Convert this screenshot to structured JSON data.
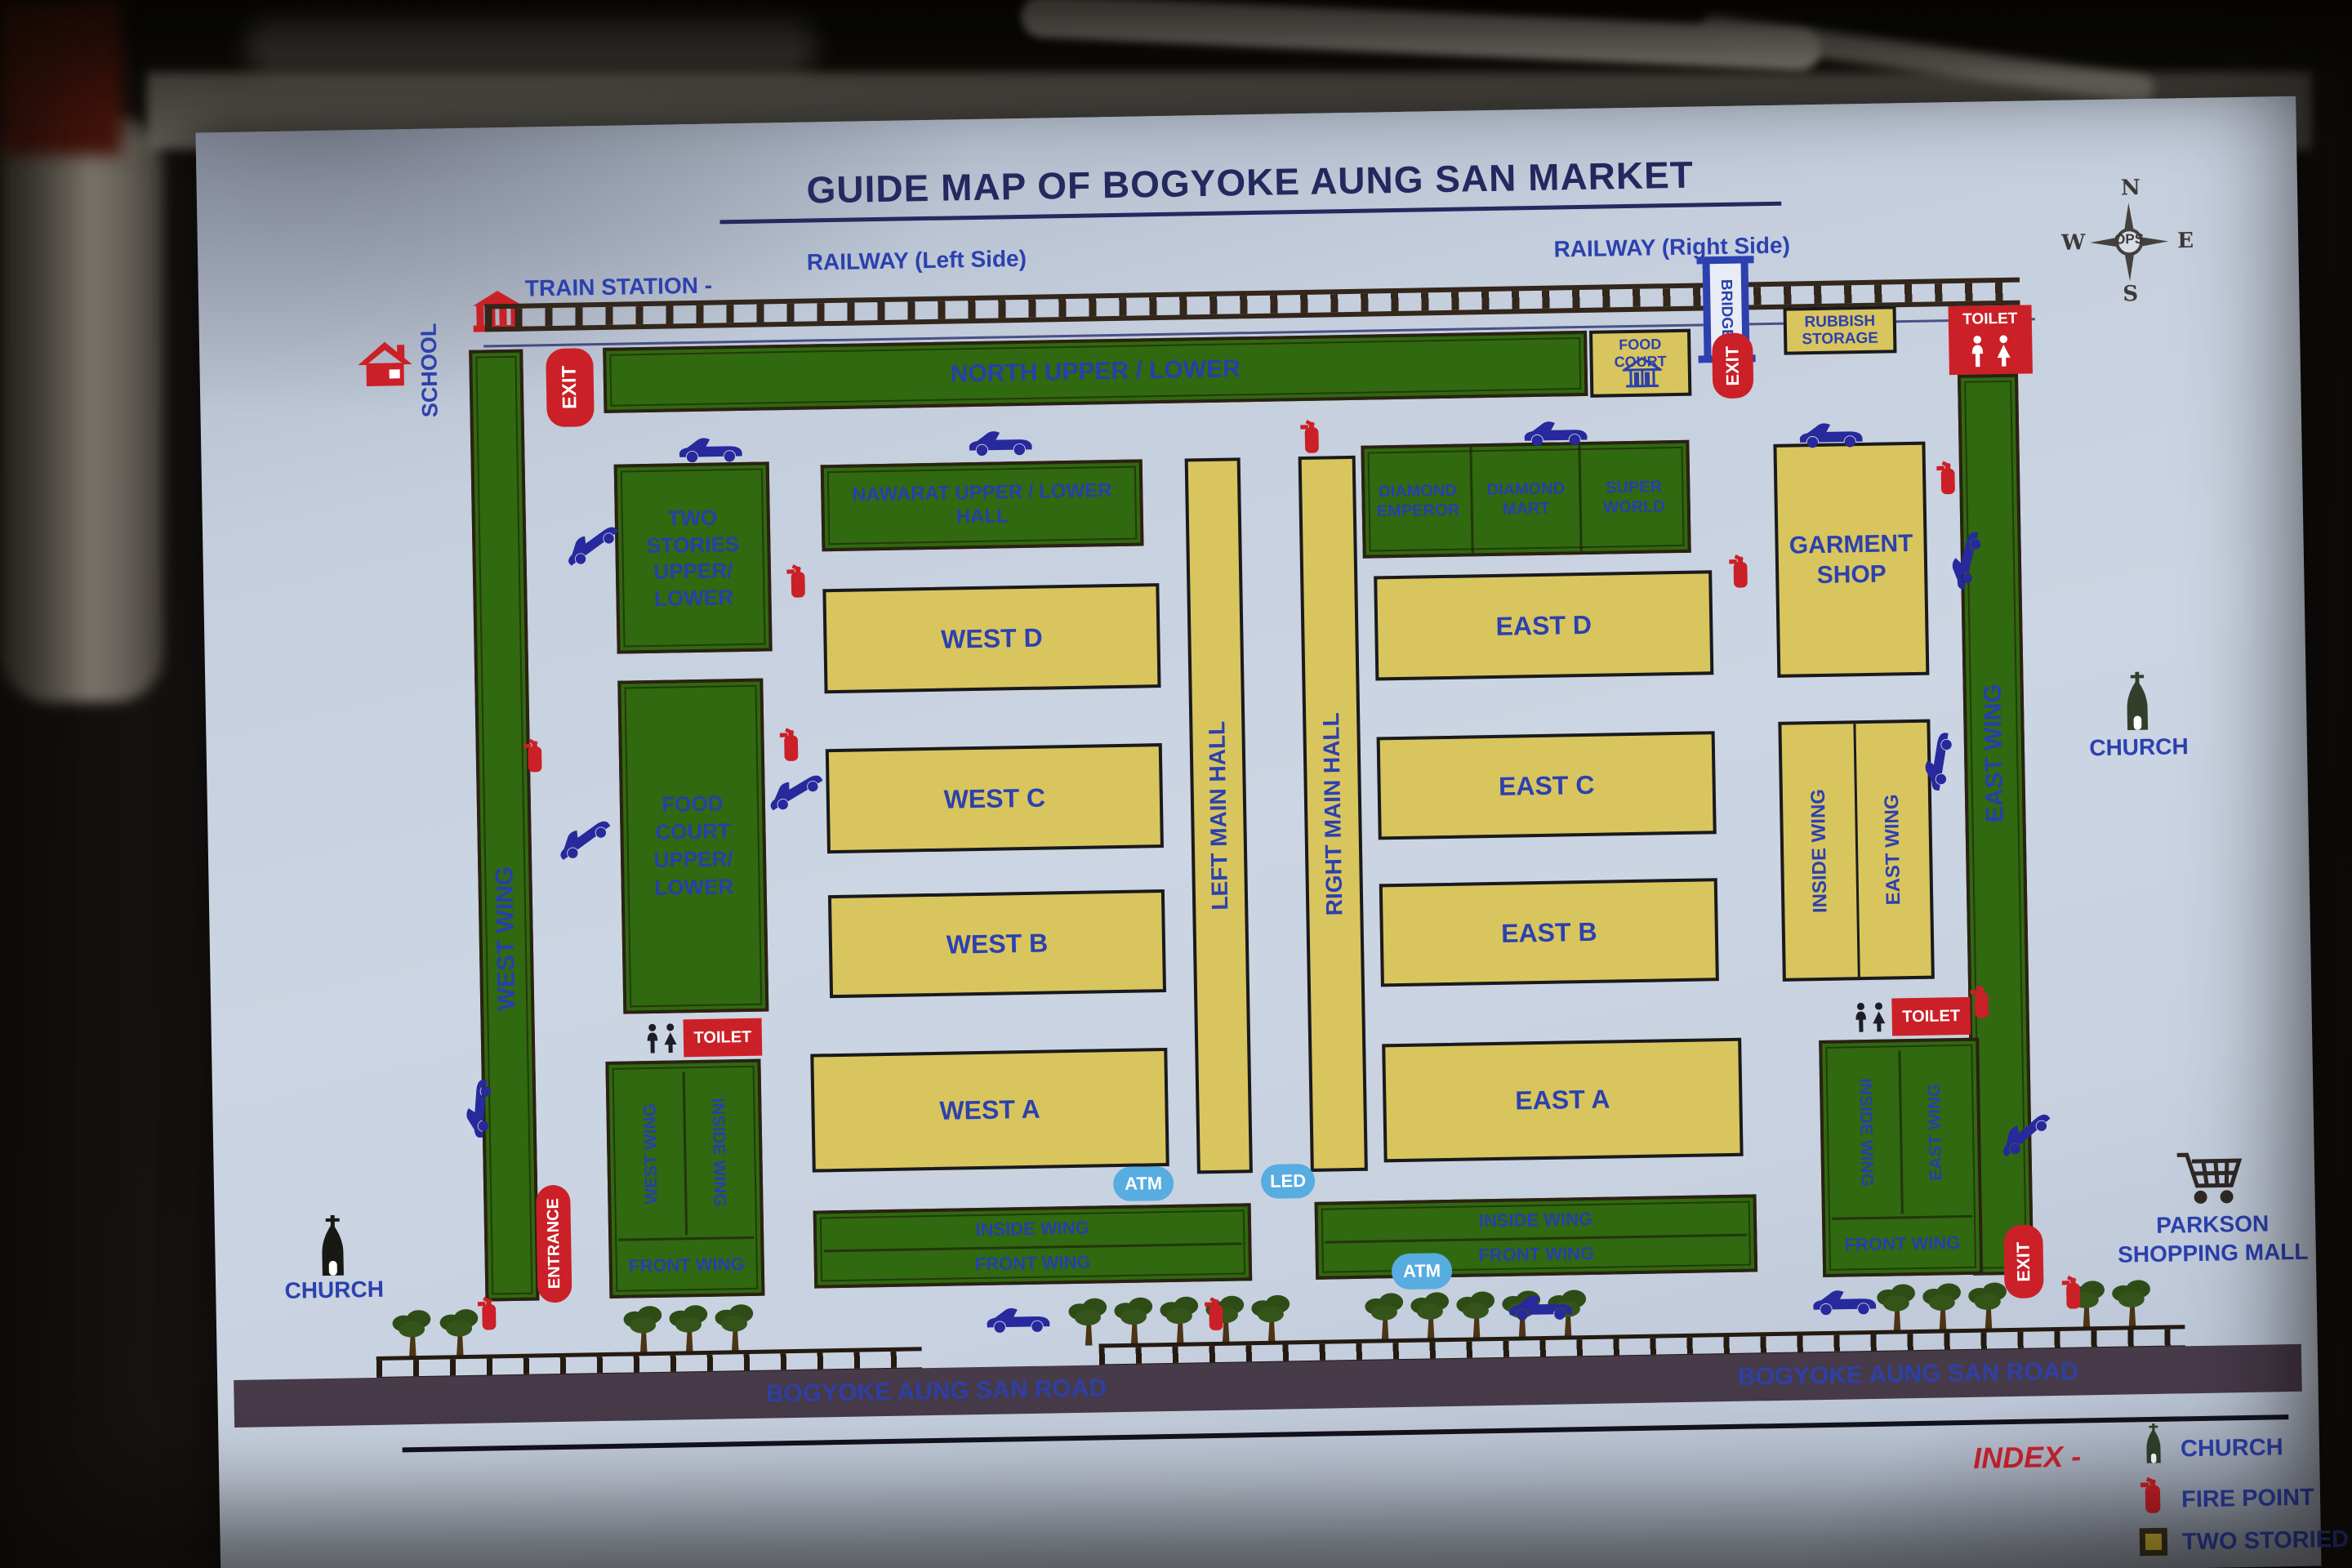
{
  "title": "GUIDE MAP OF BOGYOKE AUNG SAN MARKET",
  "compass": {
    "north": "N",
    "south": "S",
    "east": "E",
    "west": "W",
    "center": "OPS"
  },
  "railway": {
    "train_station": "TRAIN STATION -",
    "left": "RAILWAY (Left Side)",
    "right": "RAILWAY (Right Side)",
    "bridge": "BRIDGE"
  },
  "labels": {
    "school": "SCHOOL",
    "church": "CHURCH",
    "exit": "EXIT",
    "entrance": "ENTRANCE",
    "toilet": "TOILET",
    "atm": "ATM",
    "led": "LED",
    "parkson1": "PARKSON",
    "parkson2": "SHOPPING MALL"
  },
  "buildings": {
    "west_wing": "WEST WING",
    "east_wing": "EAST WING",
    "north_block": "NORTH UPPER / LOWER",
    "food_court": "FOOD COURT",
    "rubbish1": "RUBBISH",
    "rubbish2": "STORAGE",
    "two_stories": [
      "TWO",
      "STORIES",
      "UPPER/",
      "LOWER"
    ],
    "food_court_upper": [
      "FOOD",
      "COURT",
      "UPPER/",
      "LOWER"
    ],
    "nawarat1": "NAWARAT UPPER / LOWER",
    "nawarat2": "HALL",
    "diamond": [
      [
        "DIAMOND",
        "EMPEROR"
      ],
      [
        "DIAMOND",
        "MART"
      ],
      [
        "SUPER",
        "WORLD"
      ]
    ],
    "west_halls": [
      "WEST D",
      "WEST C",
      "WEST B",
      "WEST A"
    ],
    "east_halls": [
      "EAST D",
      "EAST C",
      "EAST B",
      "EAST A"
    ],
    "left_main_hall": "LEFT MAIN HALL",
    "right_main_hall": "RIGHT MAIN HALL",
    "garment1": "GARMENT",
    "garment2": "SHOP",
    "inside_wing": "INSIDE WING",
    "front_wing": "FRONT WING"
  },
  "road": {
    "name": "BOGYOKE AUNG SAN ROAD"
  },
  "index": {
    "heading": "INDEX -",
    "church": "CHURCH",
    "fire": "FIRE POINT",
    "two_storied": "TWO STORIED BUILDING"
  },
  "colors": {
    "building_green": "#30690f",
    "hall_yellow": "#d9c55e",
    "accent_red": "#cb2027",
    "label_blue": "#2c41ae",
    "road_dark": "#473a49",
    "pill_blue": "#57ace0"
  }
}
